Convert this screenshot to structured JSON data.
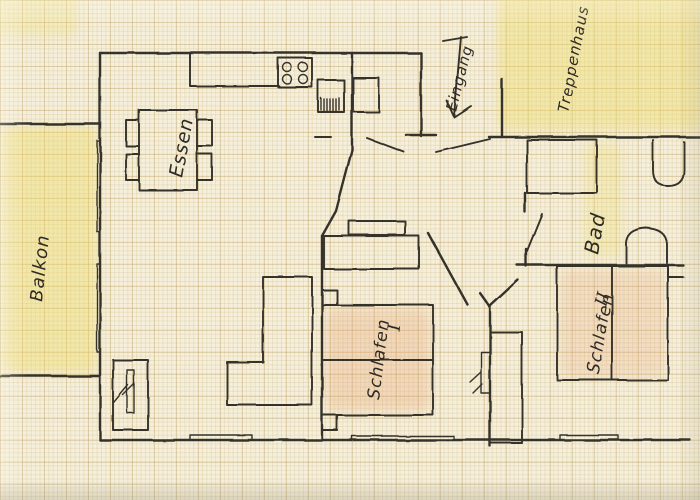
{
  "sketch": {
    "kind": "hand-drawn apartment floor plan on millimeter graph paper",
    "rooms": {
      "balkon": {
        "label": "Balkon"
      },
      "essen": {
        "label": "Essen"
      },
      "eingang": {
        "label": "Eingang"
      },
      "treppenhaus": {
        "label": "Treppenhaus"
      },
      "bad": {
        "label": "Bad"
      },
      "schlafen1": {
        "label": "Schlafen",
        "numeral": "I"
      },
      "schlafen2": {
        "label": "Schlafen",
        "numeral": "II"
      }
    },
    "fixtures": [
      "dining-table",
      "chairs",
      "kitchen-counter",
      "stove",
      "kitchen-sink",
      "hall-cabinet",
      "bathtub",
      "toilet",
      "washbasin",
      "bed-schlafen-1",
      "bed-schlafen-2",
      "l-shaped-wardrobe",
      "wardrobe",
      "sideboard",
      "nightstands",
      "radiator",
      "entrance-arrow",
      "windows",
      "balcony-doors"
    ],
    "colors": {
      "paper": "#f5efdb",
      "grid_minor": "#d9c89e",
      "grid_major": "#c4ac74",
      "ink": "#34302a",
      "highlight_yellow": "#eed954",
      "highlight_peach": "#e7965f"
    }
  }
}
